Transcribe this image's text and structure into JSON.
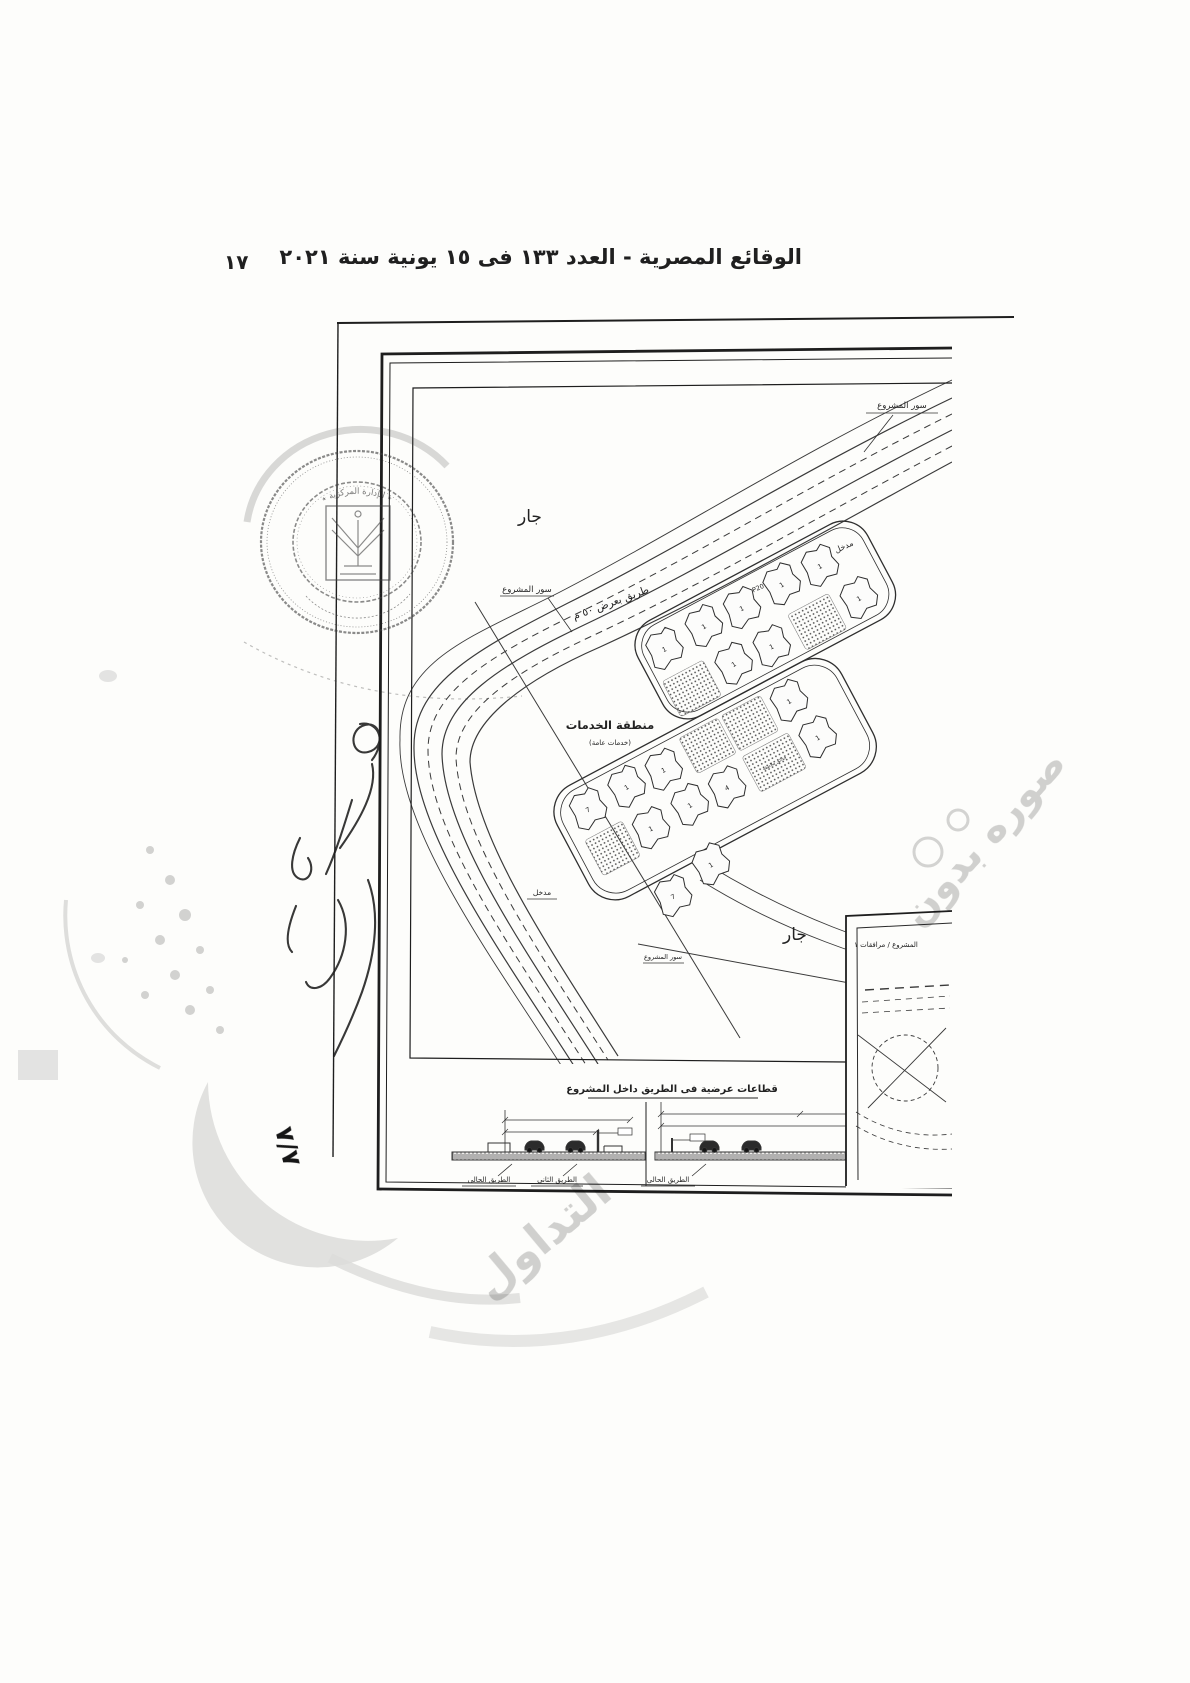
{
  "header": {
    "page_number": "١٧",
    "title": "الوقائع المصرية - العدد ١٣٣ فى ١٥ يونية سنة ٢٠٢١"
  },
  "map": {
    "labels": {
      "neighbor_top": "جار",
      "neighbor_bottom": "جار",
      "project_wall_top": "سور المشروع",
      "project_wall_left": "سور المشروع",
      "project_wall_bottom": "سور المشروع",
      "road_width": "طريق بعرض ٥٠ م",
      "services_title": "منطقة الخدمات",
      "services_subtitle": "(خدمات عامة)",
      "entrance_road": "مدخل",
      "entrance_south": "مدخل",
      "road_code": "P20",
      "garden_label": "حدائق ملاصقة"
    },
    "plot_numbers": [
      "7",
      "1",
      "1",
      "1",
      "1",
      "1",
      "4",
      "1",
      "1",
      "1",
      "1",
      "1",
      "1",
      "1",
      "1",
      "1",
      "7",
      "1"
    ],
    "inset": {
      "title": "المشروع / مرافقات ١"
    },
    "sections": {
      "title": "قطاعات عرضية فى الطريق داخل المشروع",
      "left_road_label": "الطريق الحالى",
      "middle_road_label": "الطريق الثانى",
      "right_road_label": "الطريق الحالى"
    },
    "handwritten_sheet_number": "٧/٧"
  },
  "stamp": {
    "arc_text": "٭ الإدارة المركزية ٭"
  },
  "watermark": {
    "fragment_right": "صوره بدون",
    "fragment_bottom": "التداول"
  },
  "colors": {
    "ink": "#1f1f1f",
    "line": "#333333",
    "stamp": "#4a4a4a",
    "watermark": "#d2d2d2"
  }
}
